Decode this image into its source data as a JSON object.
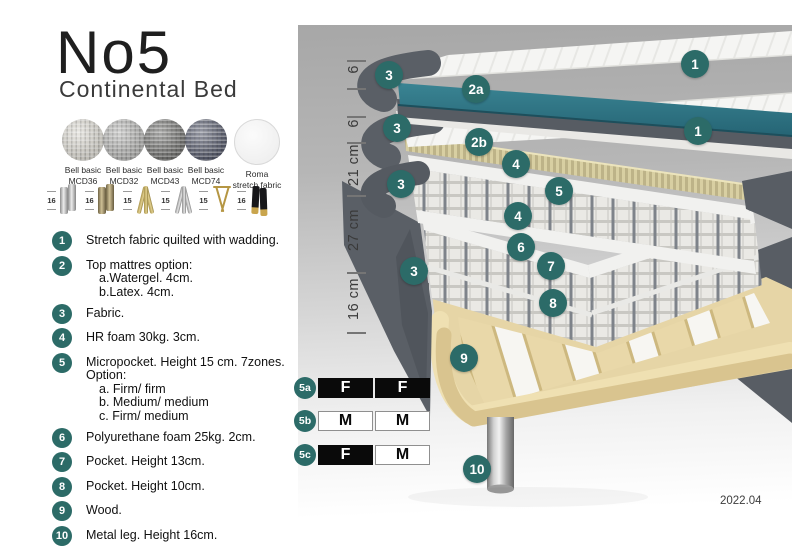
{
  "product": {
    "title": "No5",
    "subtitle": "Continental Bed"
  },
  "fabrics": [
    {
      "name": "Bell basic",
      "code": "MCD36",
      "swatch": "#d6d3ca"
    },
    {
      "name": "Bell basic",
      "code": "MCD32",
      "swatch": "#a9a9a7"
    },
    {
      "name": "Bell basic",
      "code": "MCD43",
      "swatch": "#5f5f5c"
    },
    {
      "name": "Bell basic",
      "code": "MCD74",
      "swatch": "#3f4458"
    },
    {
      "name": "Roma",
      "code": "stretch fabric",
      "swatch": "#f4f4f4"
    }
  ],
  "legs": [
    {
      "height": "16",
      "style": "cylinder-silver"
    },
    {
      "height": "16",
      "style": "cylinder-bronze"
    },
    {
      "height": "15",
      "style": "twisted-gold"
    },
    {
      "height": "15",
      "style": "twisted-silver"
    },
    {
      "height": "15",
      "style": "hairpin-gold"
    },
    {
      "height": "16",
      "style": "block-black-gold"
    }
  ],
  "features": [
    {
      "num": "1",
      "text": "Stretch fabric quilted with wadding."
    },
    {
      "num": "2",
      "text": "Top mattres option:",
      "sub": [
        "a.Watergel. 4cm.",
        "b.Latex. 4cm."
      ]
    },
    {
      "num": "3",
      "text": "Fabric."
    },
    {
      "num": "4",
      "text": "HR foam 30kg. 3cm."
    },
    {
      "num": "5",
      "text": "Micropocket. Height 15 cm. 7zones. Option:",
      "sub": [
        "a. Firm/ firm",
        "b. Medium/ medium",
        "c. Firm/ medium"
      ]
    },
    {
      "num": "6",
      "text": "Polyurethane foam 25kg. 2cm."
    },
    {
      "num": "7",
      "text": "Pocket. Height 13cm."
    },
    {
      "num": "8",
      "text": "Pocket. Height 10cm."
    },
    {
      "num": "9",
      "text": "Wood."
    },
    {
      "num": "10",
      "text": "Metal leg. Height 16cm."
    }
  ],
  "diagram": {
    "dimensions": [
      "6",
      "6",
      "21 cm",
      "27 cm",
      "16 cm"
    ],
    "markers": {
      "top_stretch": "1",
      "top_fabric": "3",
      "top_watergel": "2a",
      "mid_stretch": "1",
      "mid_fabric_upper": "3",
      "mid_latex": "2b",
      "mid_hrfoam_upper": "4",
      "mid_micropocket": "5",
      "mid_fabric_lower": "3",
      "mid_hrfoam_lower": "4",
      "low_pufoam": "6",
      "low_pocket13": "7",
      "low_fabric": "3",
      "low_pocket10": "8",
      "wood": "9",
      "metal_leg": "10"
    },
    "firmness": [
      {
        "label": "5a",
        "cells": [
          "F",
          "F"
        ],
        "styles": [
          "dark",
          "dark"
        ]
      },
      {
        "label": "5b",
        "cells": [
          "M",
          "M"
        ],
        "styles": [
          "light",
          "light"
        ]
      },
      {
        "label": "5c",
        "cells": [
          "F",
          "M"
        ],
        "styles": [
          "dark",
          "light"
        ]
      }
    ],
    "version": "2022.04",
    "colors": {
      "marker_teal": "#2c6b68",
      "watergel_teal": "#2f7586",
      "fabric_grey": "#5a5f66",
      "latex_tan": "#d8cfa2",
      "wood": "#e6d5a6"
    }
  }
}
